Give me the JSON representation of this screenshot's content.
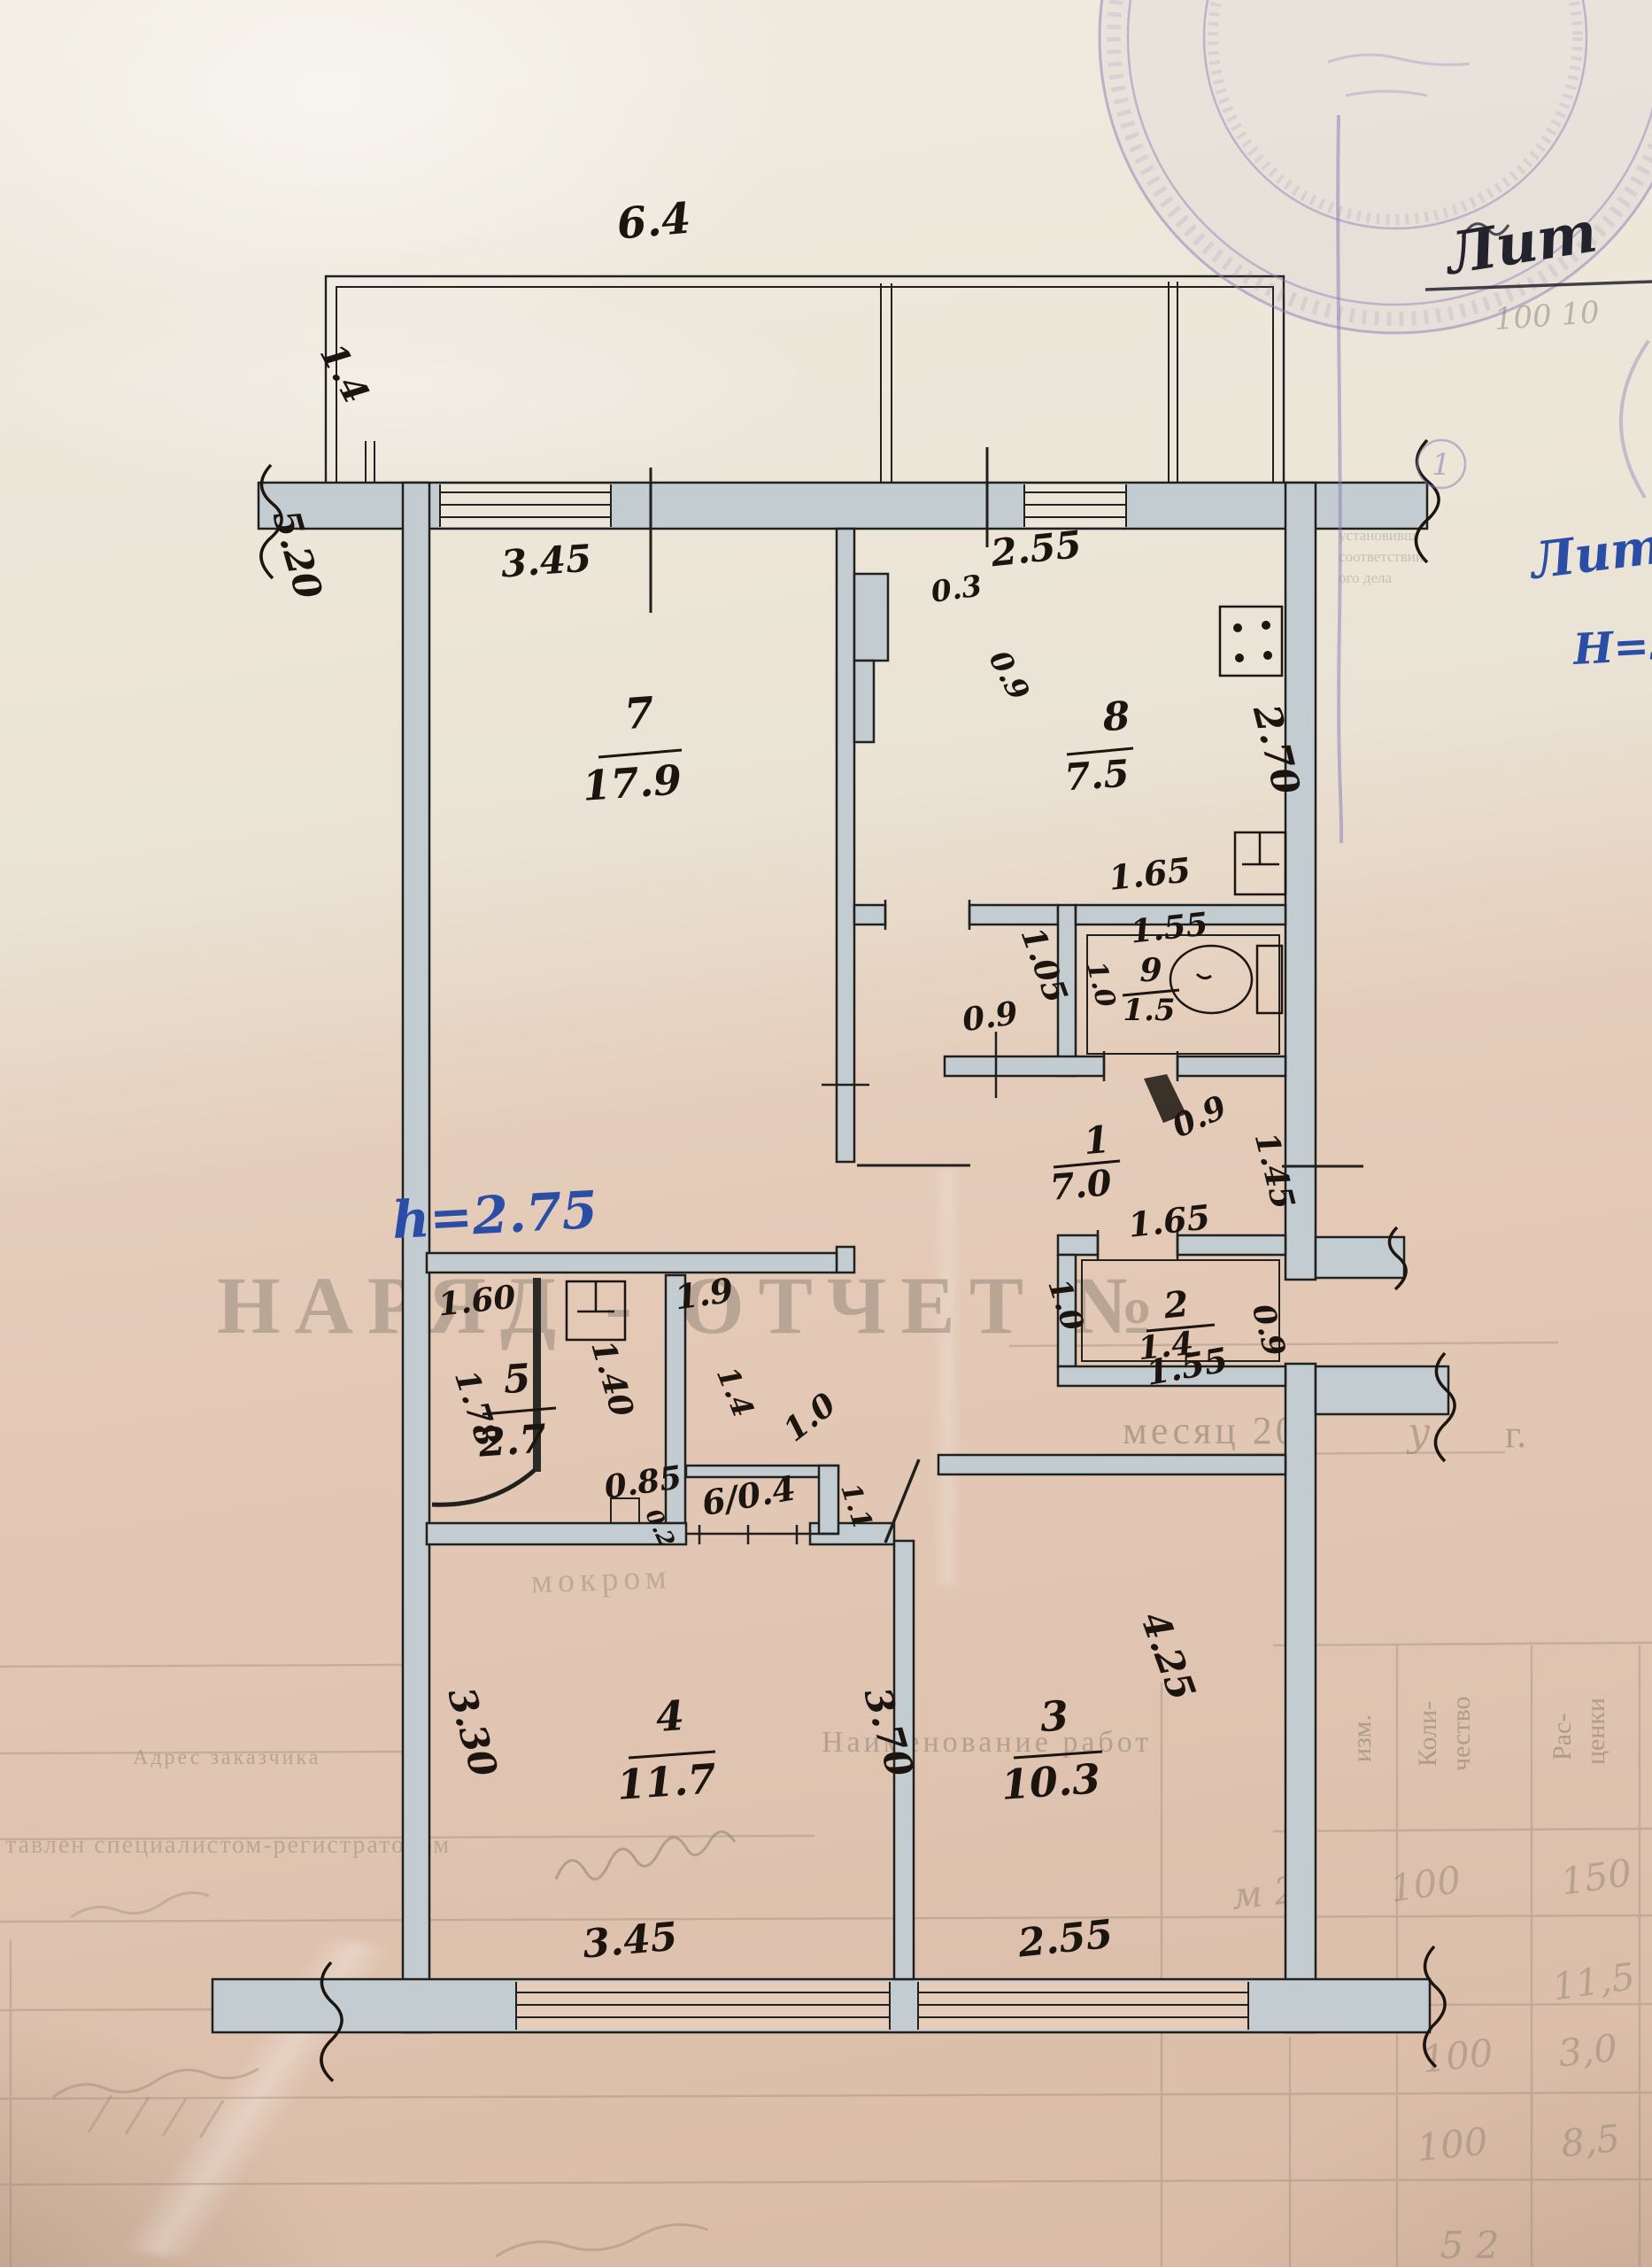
{
  "colors": {
    "ink": "#1c150f",
    "blue_pen": "#2a4da6",
    "stamp_purple": "#837cb6",
    "pencil": "#8a7d6e",
    "wall_fill": "#c3ccd0",
    "paper_cream": "#ebe5d8",
    "paper_pink": "#e3c9b6"
  },
  "rooms": {
    "r1": {
      "n": "1",
      "a": "7.0"
    },
    "r2": {
      "n": "2",
      "a": "1.4"
    },
    "r3": {
      "n": "3",
      "a": "10.3"
    },
    "r4": {
      "n": "4",
      "a": "11.7"
    },
    "r5": {
      "n": "5",
      "a": "2.7"
    },
    "r6": {
      "inline": "6/0.4"
    },
    "r7": {
      "n": "7",
      "a": "17.9"
    },
    "r8": {
      "n": "8",
      "a": "7.5"
    },
    "r9": {
      "n": "9",
      "a": "1.5"
    }
  },
  "dims": {
    "balconyW": "6.4",
    "balconyD": "1.4",
    "room7W": "3.45",
    "room8W": "2.55",
    "vent1": "0.3",
    "vent2": "0.9",
    "kitchenH": "2.70",
    "room7H": "5.20",
    "bathTop": "1.65",
    "bathW": "1.55",
    "bathL": "1.05",
    "bathL2": "1.0",
    "niche": "0.9",
    "bathDoor": "0.9",
    "hallR": "1.45",
    "wcTop": "1.65",
    "wcW": "1.55",
    "wcR": "0.9",
    "wcL": "1.0",
    "hallDoor": "1.0",
    "hallW": "1.9",
    "clW": "1.60",
    "clH": "1.78",
    "clD": "1.40",
    "clD2": "1.4",
    "clR": "1.1",
    "clB": "0.85",
    "step": "0.2",
    "room4H": "3.30",
    "room3L": "3.70",
    "room3H": "4.25",
    "room4W": "3.45",
    "room3W": "2.55"
  },
  "notes": {
    "ceiling": "h=2.75",
    "litInk": "Лит",
    "litBlue": "Лит",
    "heightNote": "Н=3.00",
    "pencilNum": "100 10",
    "mark": "у",
    "stampNum": "1"
  },
  "bleed": {
    "title": "НАРЯД - ОТЧЕТ №",
    "month": "месяц 200",
    "year": "г.",
    "works": "Наименование работ",
    "address": "Адрес заказчика",
    "unit": "изм.",
    "qty1": "Коли-",
    "qty2": "чество",
    "rate1": "Рас-",
    "rate2": "ценки",
    "specialist": "тавлен специалистом-регистратором",
    "word": "мокром",
    "frag1": "и в связи",
    "frag2": "прописыва",
    "frag3": "установивш",
    "frag4": "соответствии",
    "frag5": "ого дела",
    "cell_u1": "м 2",
    "cell_q1": "100",
    "cell_r1": "150",
    "cell_r2": "11,5",
    "cell_q3": "100",
    "cell_r3": "3,0",
    "cell_q4": "100",
    "cell_r4": "8,5",
    "cell_q5": "5 2"
  }
}
